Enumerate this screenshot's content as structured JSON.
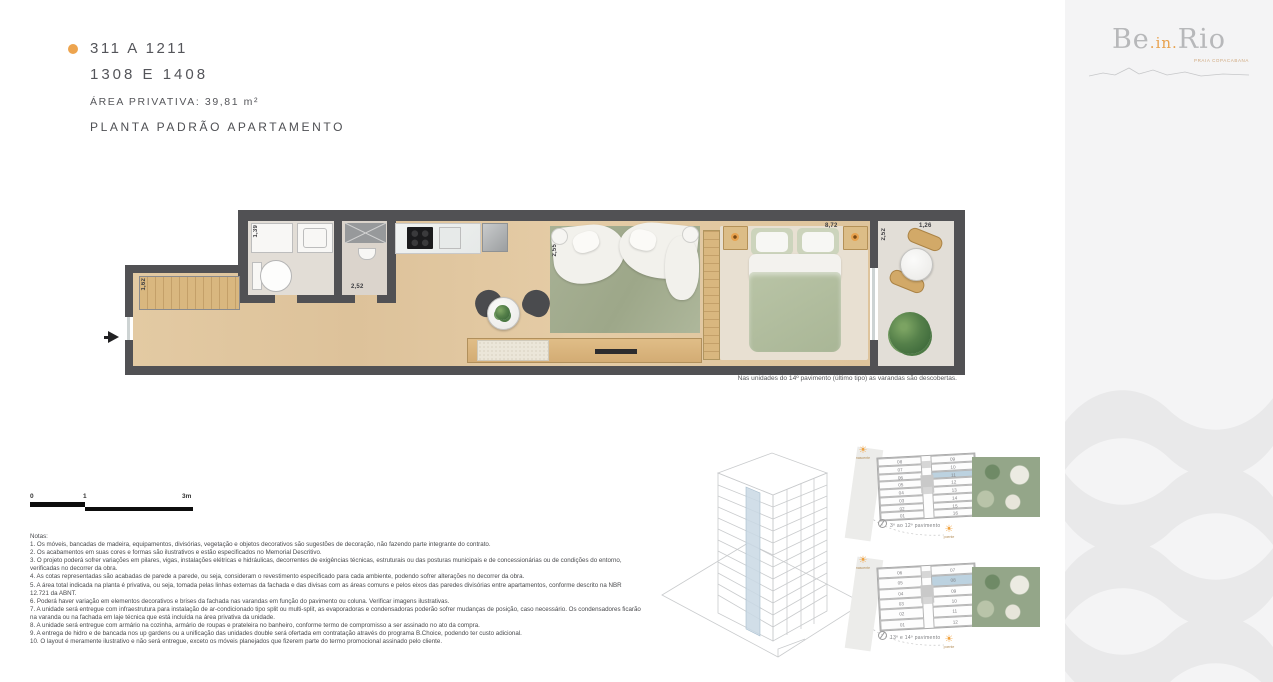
{
  "header": {
    "line1": "311 A 1211",
    "line2": "1308 E 1408",
    "area_label": "ÁREA PRIVATIVA: 39,81 m²",
    "plan_title": "PLANTA PADRÃO APARTAMENTO",
    "bullet_color": "#EDA44E"
  },
  "logo": {
    "part1": "Be",
    "mid": ".in.",
    "part2": "Rio",
    "subtitle": "PRAIA COPACABANA"
  },
  "plan": {
    "dims": {
      "closet": "1,62",
      "bath": "1,39",
      "service": "2,52",
      "living": "2,55",
      "bedroom": "8,72",
      "balcony_depth": "2,52",
      "balcony_width": "1,26"
    },
    "footnote": "Nas unidades do 14º pavimento (último tipo) as varandas são descobertas."
  },
  "scalebar": {
    "t0": "0",
    "t1": "1",
    "t3": "3m"
  },
  "notes": {
    "title": "Notas:",
    "items": [
      "1. Os móveis, bancadas de madeira, equipamentos, divisórias, vegetação e objetos decorativos são sugestões de decoração, não fazendo parte integrante do contrato.",
      "2. Os acabamentos em suas cores e formas são ilustrativos e estão especificados no Memorial Descritivo.",
      "3. O projeto poderá sofrer variações em pilares, vigas, instalações elétricas e hidráulicas, decorrentes de exigências técnicas, estruturais ou das posturas municipais e de concessionárias ou de condições do entorno, verificadas no decorrer da obra.",
      "4. As cotas representadas são acabadas de parede a parede, ou seja, consideram o revestimento especificado para cada ambiente, podendo sofrer alterações no decorrer da obra.",
      "5. A área total indicada na planta é privativa, ou seja, tomada pelas linhas externas da fachada e das divisas com as áreas comuns e pelos eixos das paredes divisórias entre apartamentos, conforme descrito na NBR 12.721 da ABNT.",
      "6. Poderá haver variação em elementos decorativos e brises da fachada nas varandas em função do pavimento ou coluna. Verificar imagens ilustrativas.",
      "7. A unidade será entregue com infraestrutura para instalação de ar-condicionado tipo split ou multi-split, as evaporadoras e condensadoras poderão sofrer mudanças de posição, caso necessário. Os condensadores ficarão na varanda ou na fachada em laje técnica que está incluída na área privativa da unidade.",
      "8. A unidade será entregue com armário na cozinha, armário de roupas e prateleira no banheiro, conforme termo de compromisso a ser assinado no ato da compra.",
      "9. A entrega de hidro e de bancada nos up gardens ou a unificação das unidades double será ofertada em contratação através do programa B.Choice, podendo ter custo adicional.",
      "10. O layout é meramente ilustrativo e não será entregue, exceto os móveis planejados que fizerem parte do termo promocional assinado pelo cliente."
    ]
  },
  "keyplans": [
    {
      "caption": "3º ao 12º pavimento",
      "left_units": [
        "08",
        "07",
        "06",
        "05",
        "04",
        "03",
        "02",
        "01"
      ],
      "right_units": [
        "09",
        "10",
        "11",
        "12",
        "13",
        "14",
        "15",
        "16"
      ],
      "highlighted_unit": "11",
      "sun_top": "nascente",
      "sun_bottom": "poente"
    },
    {
      "caption": "13º e 14º pavimento",
      "left_units": [
        "06",
        "05",
        "04",
        "03",
        "02",
        "01"
      ],
      "right_units": [
        "07",
        "08",
        "09",
        "10",
        "11",
        "12"
      ],
      "highlighted_unit": "08",
      "sun_top": "nascente",
      "sun_bottom": "poente"
    }
  ],
  "colors": {
    "accent_orange": "#EDA44E",
    "wall_gray": "#515154",
    "highlight_blue": "#BCD2E0",
    "band_gray": "#F4F4F5"
  }
}
